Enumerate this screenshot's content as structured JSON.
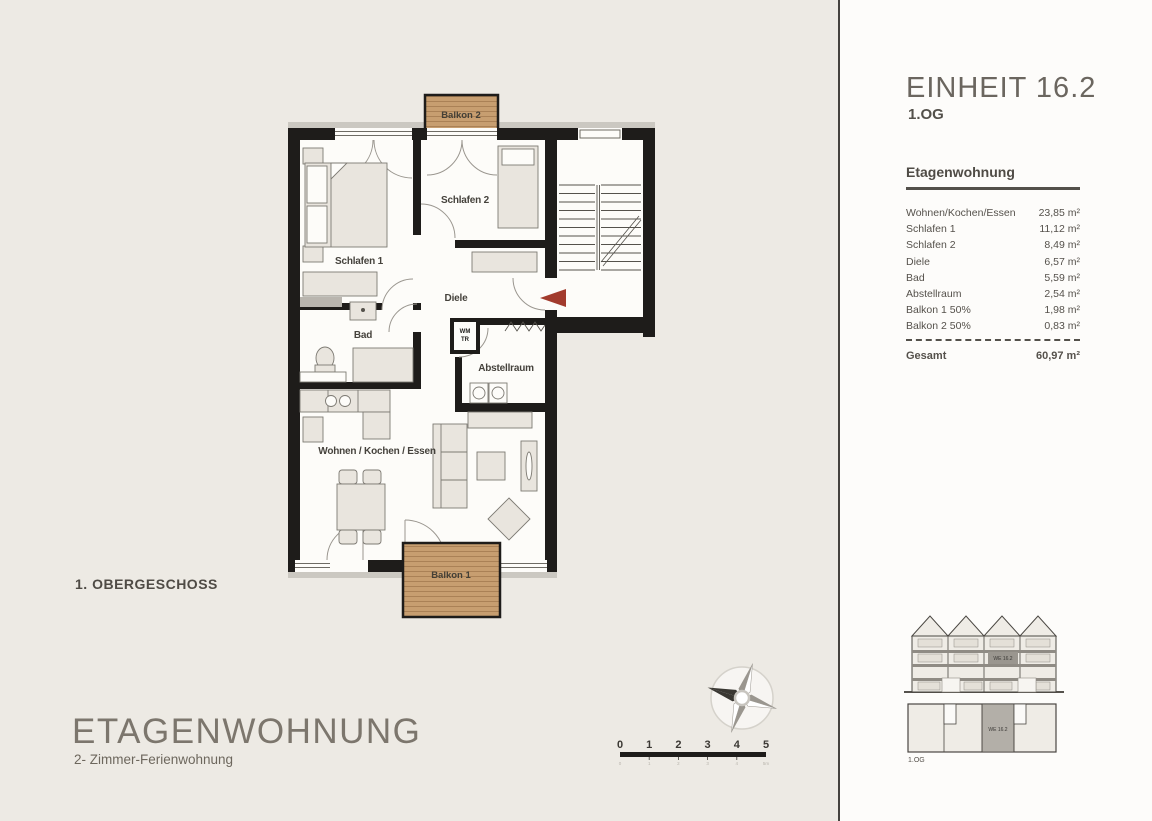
{
  "panel": {
    "title": "EINHEIT 16.2",
    "floor": "1.OG",
    "section_title": "Etagenwohnung",
    "rows": [
      {
        "label": "Wohnen/Kochen/Essen",
        "value": "23,85 m²"
      },
      {
        "label": "Schlafen 1",
        "value": "11,12 m²"
      },
      {
        "label": "Schlafen 2",
        "value": "8,49 m²"
      },
      {
        "label": "Diele",
        "value": "6,57 m²"
      },
      {
        "label": "Bad",
        "value": "5,59 m²"
      },
      {
        "label": "Abstellraum",
        "value": "2,54 m²"
      },
      {
        "label": "Balkon 1 50%",
        "value": "1,98 m²"
      },
      {
        "label": "Balkon 2 50%",
        "value": "0,83 m²"
      }
    ],
    "total_label": "Gesamt",
    "total_value": "60,97 m²",
    "elevation": {
      "unit_label": "WE 16.2"
    },
    "keyplan": {
      "unit_label": "WE 16.2",
      "floor_label": "1.OG"
    }
  },
  "main": {
    "floor_label": "1. OBERGESCHOSS",
    "title": "ETAGENWOHNUNG",
    "subtitle": "2- Zimmer-Ferienwohnung"
  },
  "plan": {
    "labels": {
      "schlafen1": "Schlafen 1",
      "schlafen2": "Schlafen 2",
      "diele": "Diele",
      "bad": "Bad",
      "abstellraum": "Abstellraum",
      "wohnen": "Wohnen / Kochen / Essen",
      "balkon1": "Balkon 1",
      "balkon2": "Balkon 2",
      "wm": "WM",
      "tr": "TR"
    }
  },
  "scalebar": {
    "numbers": [
      "0",
      "1",
      "2",
      "3",
      "4",
      "5"
    ],
    "sub": [
      "0",
      "1",
      "2",
      "3",
      "4",
      "5m"
    ]
  },
  "colors": {
    "background": "#edeae4",
    "panel_background": "#fdfcfa",
    "wall": "#1e1c1a",
    "wood": "#c79e70",
    "accent_red": "#a23b2d",
    "text": "#55514b"
  }
}
